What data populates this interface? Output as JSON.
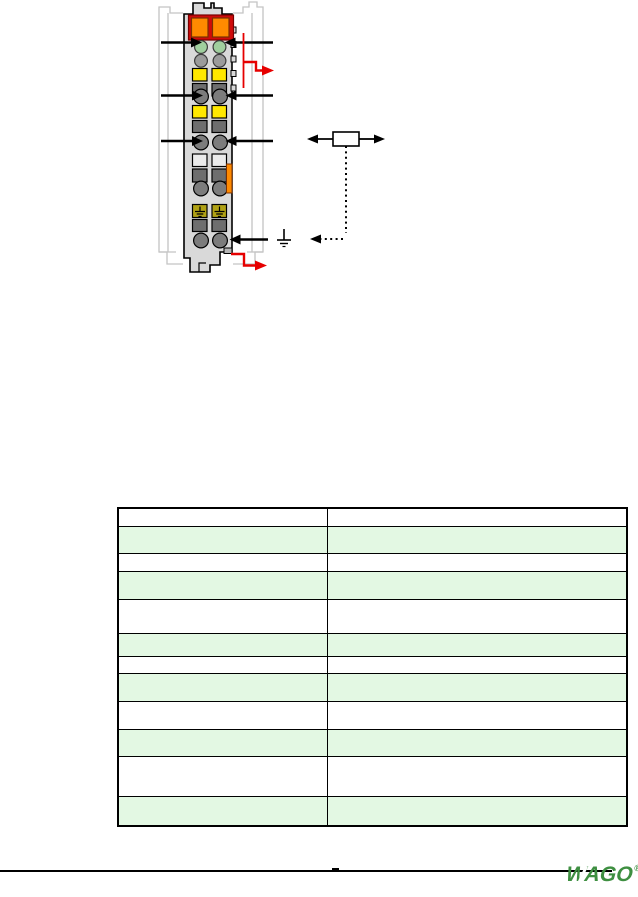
{
  "page": {
    "background": "#ffffff"
  },
  "colors": {
    "page_bg": "#ffffff",
    "ghost": "#c4c4c4",
    "module_body": "#d9d9d9",
    "latch_red": "#cf0a0a",
    "latch_orange": "#ff8a00",
    "led_green": "#a0cf9e",
    "led_gray": "#9b9b9b",
    "slot_yellow": "#ffe800",
    "slot_dark": "#6e6e6e",
    "slot_white": "#ebebeb",
    "slot_olive": "#b1a215",
    "clamp_gray": "#7c7c7c",
    "accent_red": "#e60000",
    "table_green": "#e3f8e3",
    "logo_green": "#3e8f41",
    "line_black": "#000000"
  },
  "diagram": {
    "subject": "terminal-block-module-front-view",
    "icons": {
      "pointer_arrows": "black-horizontal-arrow",
      "power_jumper": "red-step-arrow",
      "sensor": "resistor-box-symbol",
      "shield_link": "dotted-arrow-line",
      "ground": "earth-ground-symbol",
      "leds": "status-led-circles",
      "latch": "orange-pull-latch"
    }
  },
  "table": {
    "column_count": 2,
    "rows": [
      {
        "shade": "white",
        "height": 18,
        "cells": [
          "",
          ""
        ]
      },
      {
        "shade": "green",
        "height": 27,
        "cells": [
          "",
          ""
        ]
      },
      {
        "shade": "white",
        "height": 18,
        "cells": [
          "",
          ""
        ]
      },
      {
        "shade": "green",
        "height": 28,
        "cells": [
          "",
          ""
        ]
      },
      {
        "shade": "white",
        "height": 34,
        "cells": [
          "",
          ""
        ]
      },
      {
        "shade": "green",
        "height": 23,
        "cells": [
          "",
          ""
        ]
      },
      {
        "shade": "white",
        "height": 17,
        "cells": [
          "",
          ""
        ]
      },
      {
        "shade": "green",
        "height": 28,
        "cells": [
          "",
          ""
        ]
      },
      {
        "shade": "white",
        "height": 28,
        "cells": [
          "",
          ""
        ]
      },
      {
        "shade": "green",
        "height": 27,
        "cells": [
          "",
          ""
        ]
      },
      {
        "shade": "white",
        "height": 40,
        "cells": [
          "",
          ""
        ]
      },
      {
        "shade": "green",
        "height": 28,
        "cells": [
          "",
          ""
        ]
      }
    ]
  },
  "footer": {
    "logo_text": "WAGO",
    "registered_mark": "®"
  }
}
